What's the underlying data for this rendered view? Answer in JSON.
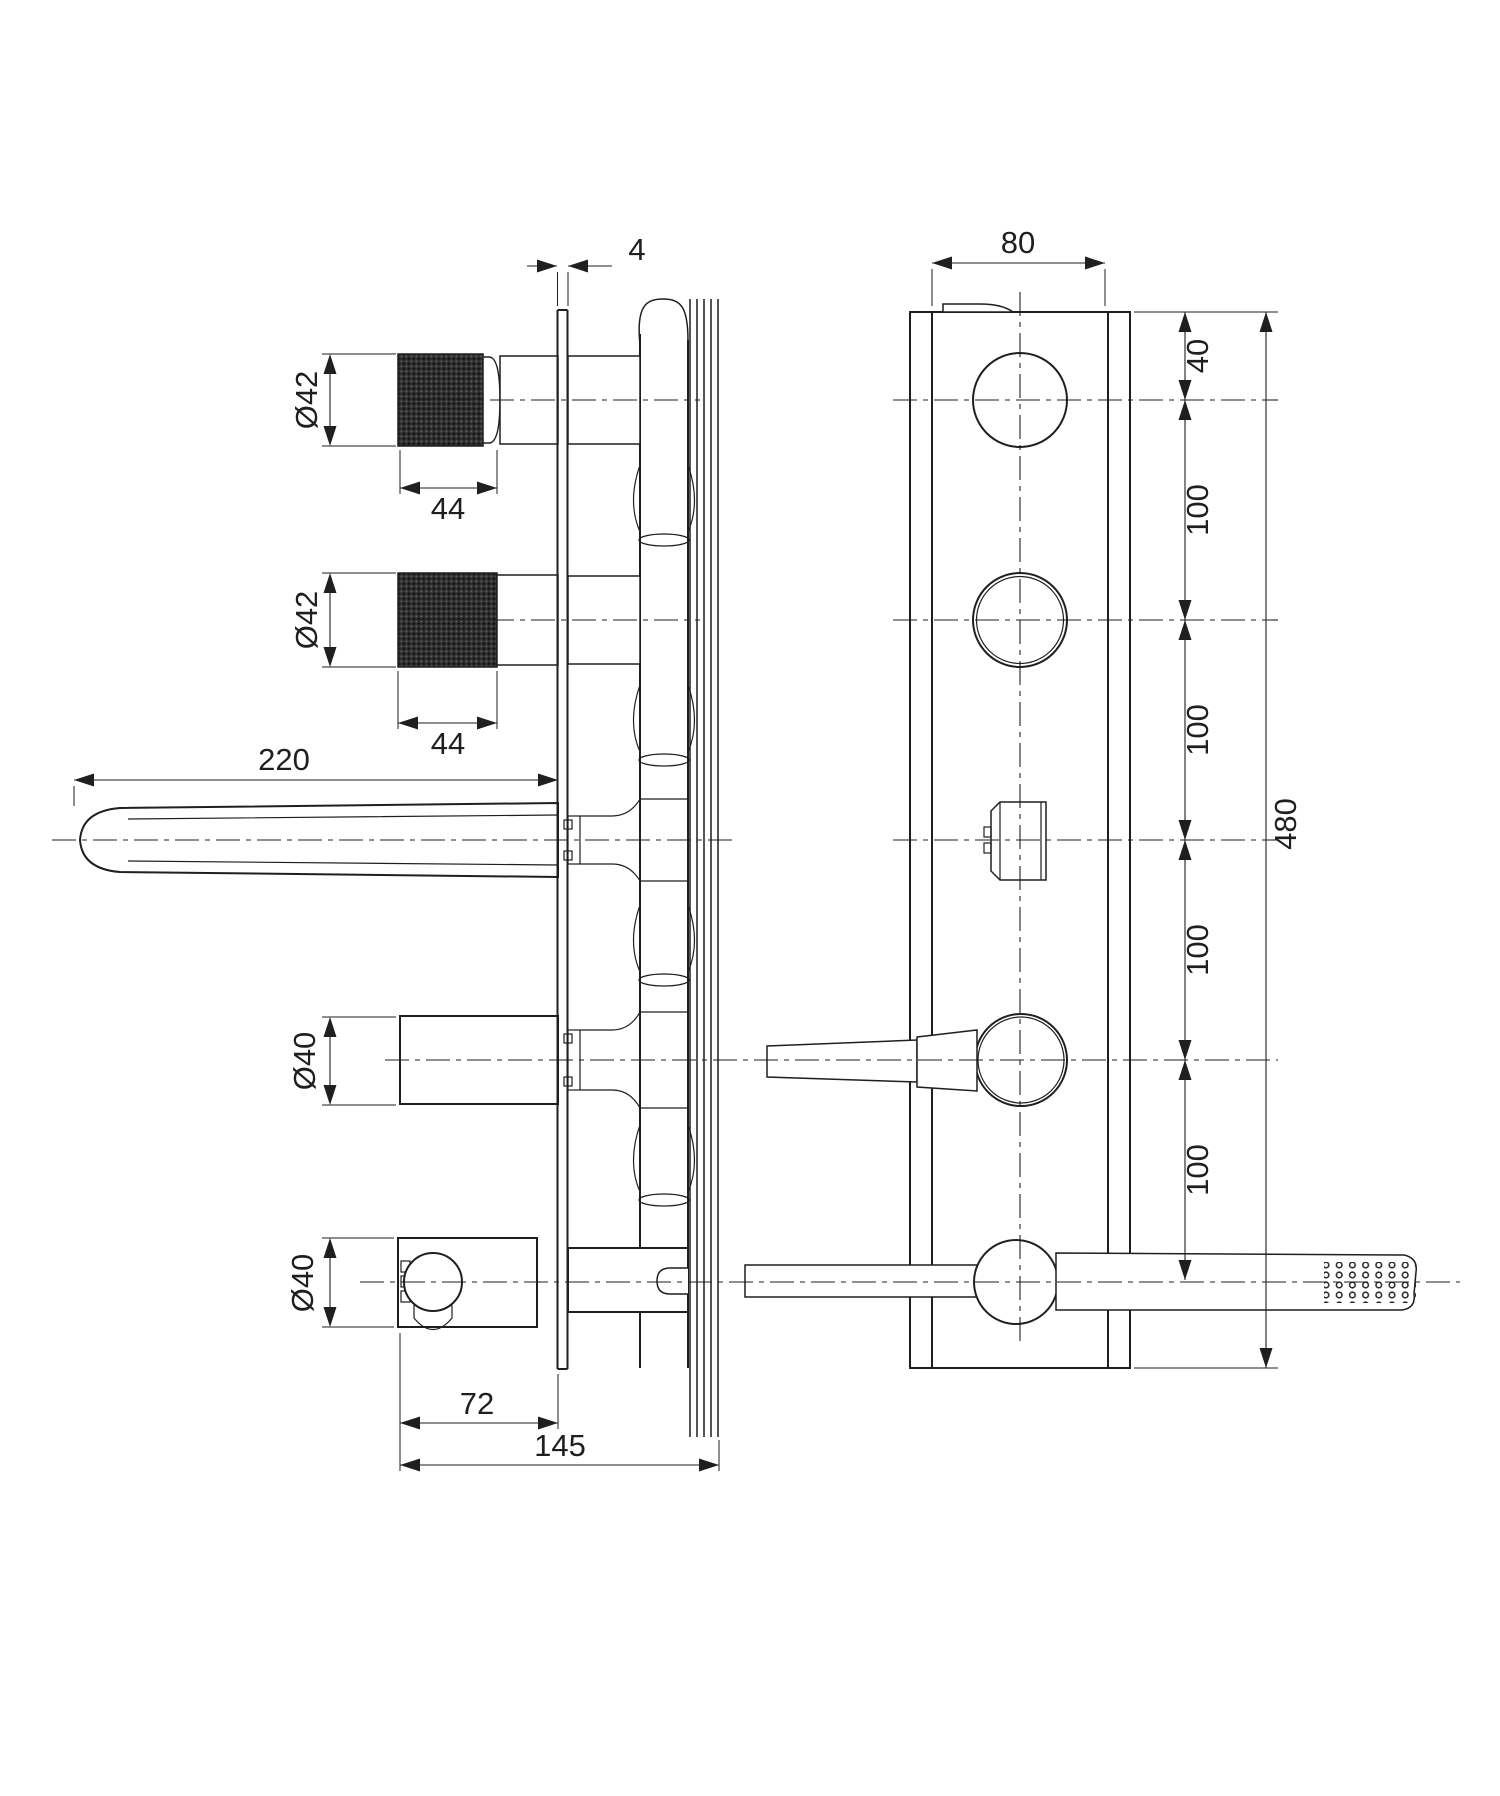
{
  "drawing": {
    "type": "technical-drawing",
    "subject": "concealed bath shower mixer - side and front elevation with dimensions",
    "colors": {
      "line": "#1f1f1f",
      "background": "#ffffff",
      "knurl": "#2e2e2e"
    },
    "views": {
      "side": {
        "dims": {
          "plate_thickness": "4",
          "top_handle_diameter": "Ø42",
          "top_handle_length": "44",
          "mid_handle_diameter": "Ø42",
          "mid_handle_length": "44",
          "spout_length": "220",
          "lever_diameter": "Ø40",
          "holder_diameter": "Ø40",
          "holder_depth": "72",
          "total_depth": "145"
        }
      },
      "front": {
        "dims": {
          "plate_width": "80",
          "top_offset": "40",
          "spacing_1": "100",
          "spacing_2": "100",
          "spacing_3": "100",
          "spacing_4": "100",
          "total_height": "480"
        }
      }
    }
  }
}
